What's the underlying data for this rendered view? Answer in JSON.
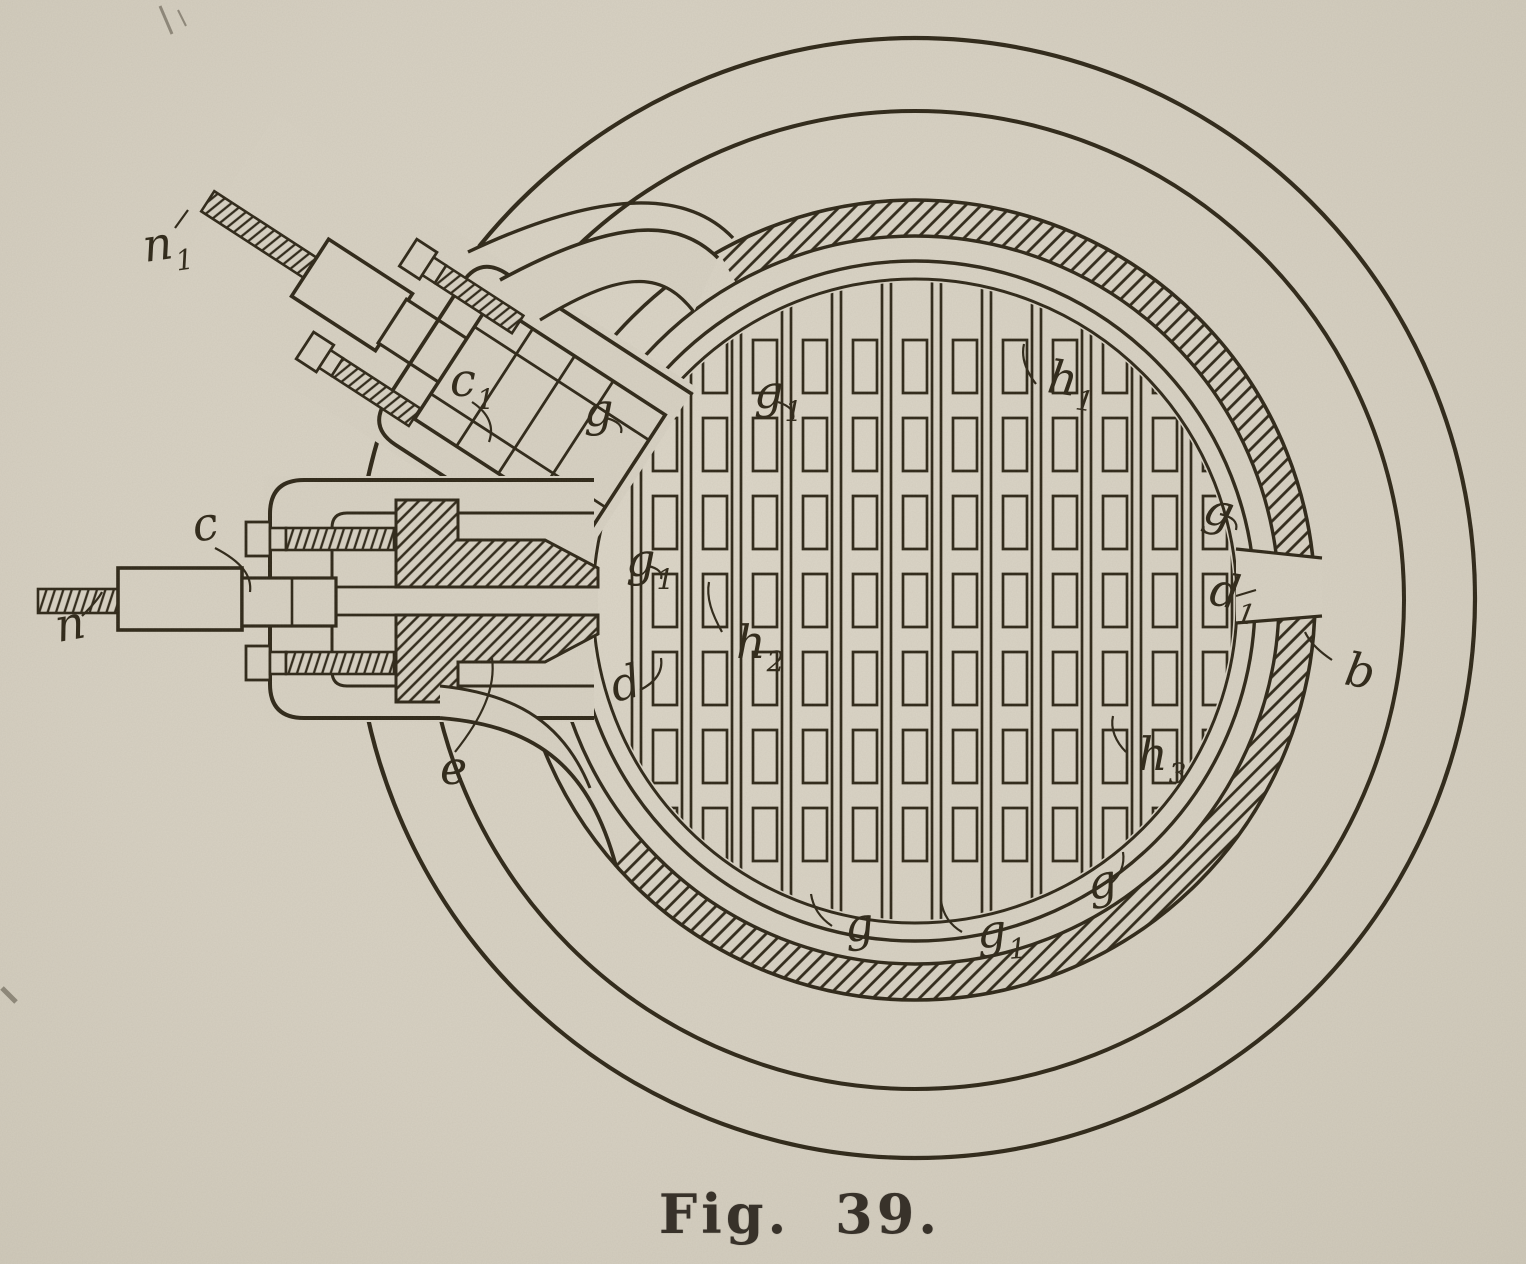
{
  "colors": {
    "paper": "#d8d2c4",
    "ink": "#2f2819",
    "caption_ink": "#38322a"
  },
  "figure": {
    "caption": "Fig. 39.",
    "labels": [
      {
        "id": "n1",
        "text": "n",
        "sub": "1"
      },
      {
        "id": "c1",
        "text": "c",
        "sub": "1"
      },
      {
        "id": "c",
        "text": "c",
        "sub": ""
      },
      {
        "id": "n",
        "text": "n",
        "sub": ""
      },
      {
        "id": "e",
        "text": "e",
        "sub": ""
      },
      {
        "id": "d_left",
        "text": "d",
        "sub": ""
      },
      {
        "id": "g_top_left",
        "text": "g",
        "sub": ""
      },
      {
        "id": "g1_top",
        "text": "g",
        "sub": "1"
      },
      {
        "id": "h1_top_right",
        "text": "h",
        "sub": "1"
      },
      {
        "id": "g1_left",
        "text": "g",
        "sub": "1"
      },
      {
        "id": "h2_center",
        "text": "h",
        "sub": "2"
      },
      {
        "id": "g_right",
        "text": "g",
        "sub": ""
      },
      {
        "id": "d1_right",
        "text": "d",
        "sub": "1"
      },
      {
        "id": "b",
        "text": "b",
        "sub": ""
      },
      {
        "id": "h3_bottom_right",
        "text": "h",
        "sub": "3"
      },
      {
        "id": "g_bottom_left",
        "text": "g",
        "sub": ""
      },
      {
        "id": "g1_bottom",
        "text": "g",
        "sub": "1"
      },
      {
        "id": "g_bottom_right",
        "text": "g",
        "sub": ""
      }
    ]
  }
}
